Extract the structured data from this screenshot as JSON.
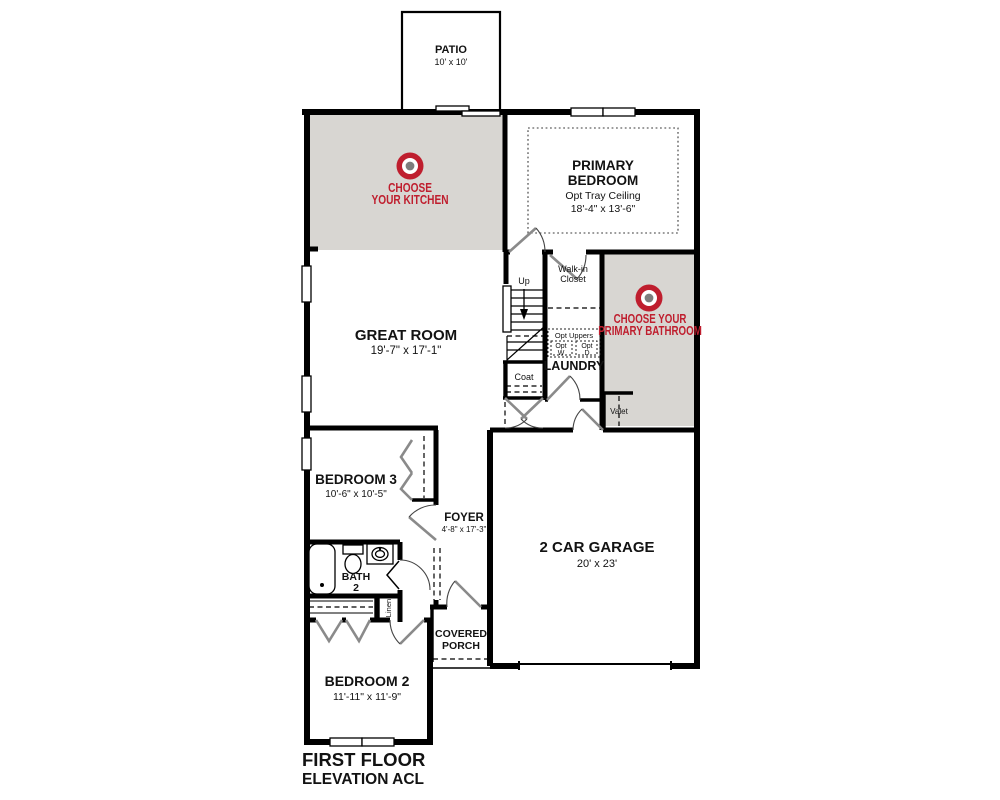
{
  "colors": {
    "accent_red": "#bf1e2e",
    "room_gray": "#d8d6d2",
    "logo_center_gray": "#7d7d7d"
  },
  "title": {
    "line1": "FIRST FLOOR",
    "line2": "ELEVATION ACL"
  },
  "rooms": {
    "patio": {
      "name": "PATIO",
      "dims": "10' x 10'"
    },
    "primary_bedroom": {
      "line1": "PRIMARY",
      "line2": "BEDROOM",
      "note": "Opt Tray Ceiling",
      "dims": "18'-4\" x 13'-6\""
    },
    "great_room": {
      "name": "GREAT ROOM",
      "dims": "19'-7\" x 17'-1\""
    },
    "bedroom3": {
      "name": "BEDROOM 3",
      "dims": "10'-6\" x 10'-5\""
    },
    "bedroom2": {
      "name": "BEDROOM 2",
      "dims": "11'-11\" x 11'-9\""
    },
    "garage": {
      "name": "2 CAR GARAGE",
      "dims": "20' x 23'"
    },
    "foyer": {
      "name": "FOYER",
      "dims": "4'-8\" x 17'-3\""
    },
    "covered_porch": {
      "line1": "COVERED",
      "line2": "PORCH"
    },
    "laundry": {
      "name": "LAUNDRY"
    },
    "bath2": {
      "line1": "BATH",
      "line2": "2"
    },
    "walk_in_closet": {
      "line1": "Walk-in",
      "line2": "Closet"
    },
    "stairs": {
      "up": "Up"
    },
    "coat": {
      "name": "Coat"
    },
    "linen": {
      "name": "Linen"
    },
    "valet": {
      "name": "Valet"
    },
    "opt_uppers": {
      "header": "Opt Uppers",
      "w_line1": "Opt",
      "w_line2": "W",
      "d_line1": "Opt",
      "d_line2": "D"
    }
  },
  "overlays": {
    "kitchen": {
      "line1": "CHOOSE",
      "line2": "YOUR KITCHEN"
    },
    "primary_bath": {
      "line1": "CHOOSE YOUR",
      "line2": "PRIMARY BATHROOM"
    }
  }
}
